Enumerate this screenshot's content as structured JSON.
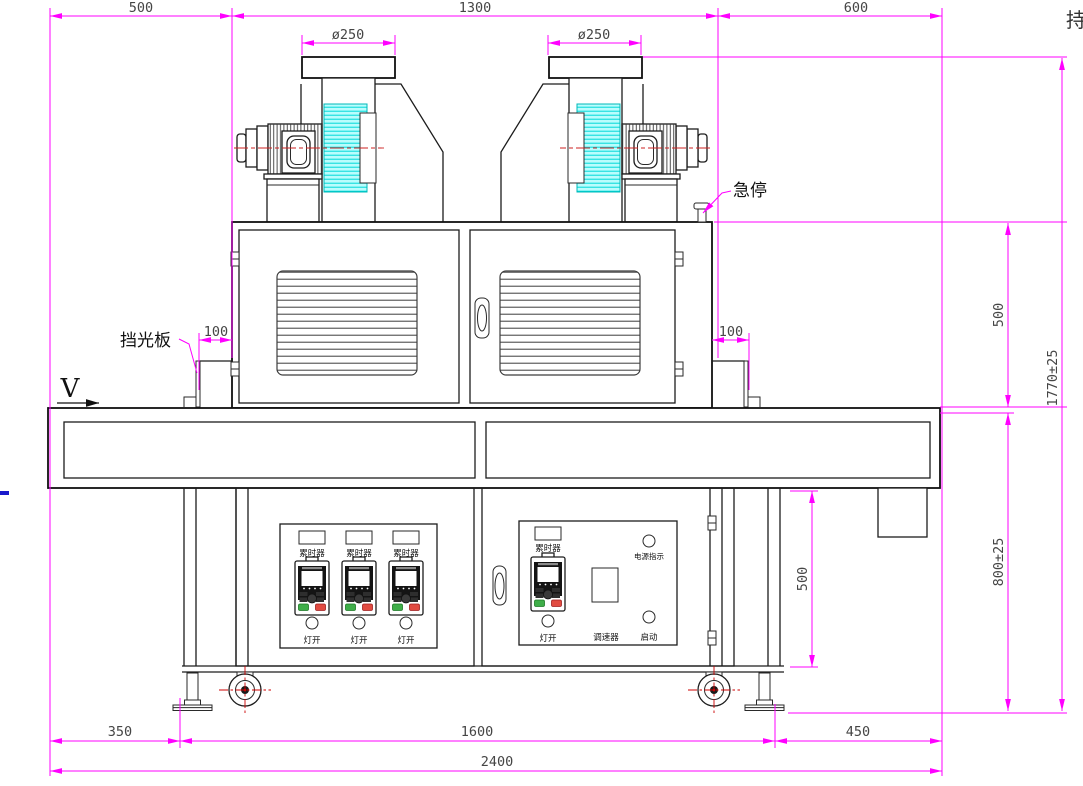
{
  "title": "UV curing machine front-view engineering drawing",
  "colors": {
    "dimension_lines": "#ff00ff",
    "drawing_lines": "#1c1c1c",
    "heatsink_fins": "#b9fdfd",
    "fin_hatch": "#00d8d8",
    "centerline_red": "#cc2222",
    "dimension_text": "#454545",
    "green_button": "#3fae49",
    "red_button": "#e14b41",
    "blue_edge_mark": "#1a1acc"
  },
  "dimensions": {
    "top_left_offset": "500",
    "top_center_span": "1300",
    "top_right_offset": "600",
    "fan_outlet_diameter_left": "ø250",
    "fan_outlet_diameter_right": "ø250",
    "light_shield_left": "100",
    "light_shield_right": "100",
    "body_height": "500",
    "overall_height": "1770±25",
    "work_height": "800±25",
    "frame_inner_height": "500",
    "bottom_left_offset": "350",
    "bottom_center_span": "1600",
    "bottom_right_offset": "450",
    "overall_width": "2400"
  },
  "labels": {
    "emergency_stop": "急停",
    "light_shield": "挡光板",
    "conveyor_direction": "V",
    "edge_clipped_text": "持"
  },
  "control_panel": {
    "timer_label": "累时器",
    "lamp_switch_label": "灯开",
    "power_indicator_label": "电源指示",
    "speed_controller_label": "调速器",
    "start_label": "启动"
  }
}
